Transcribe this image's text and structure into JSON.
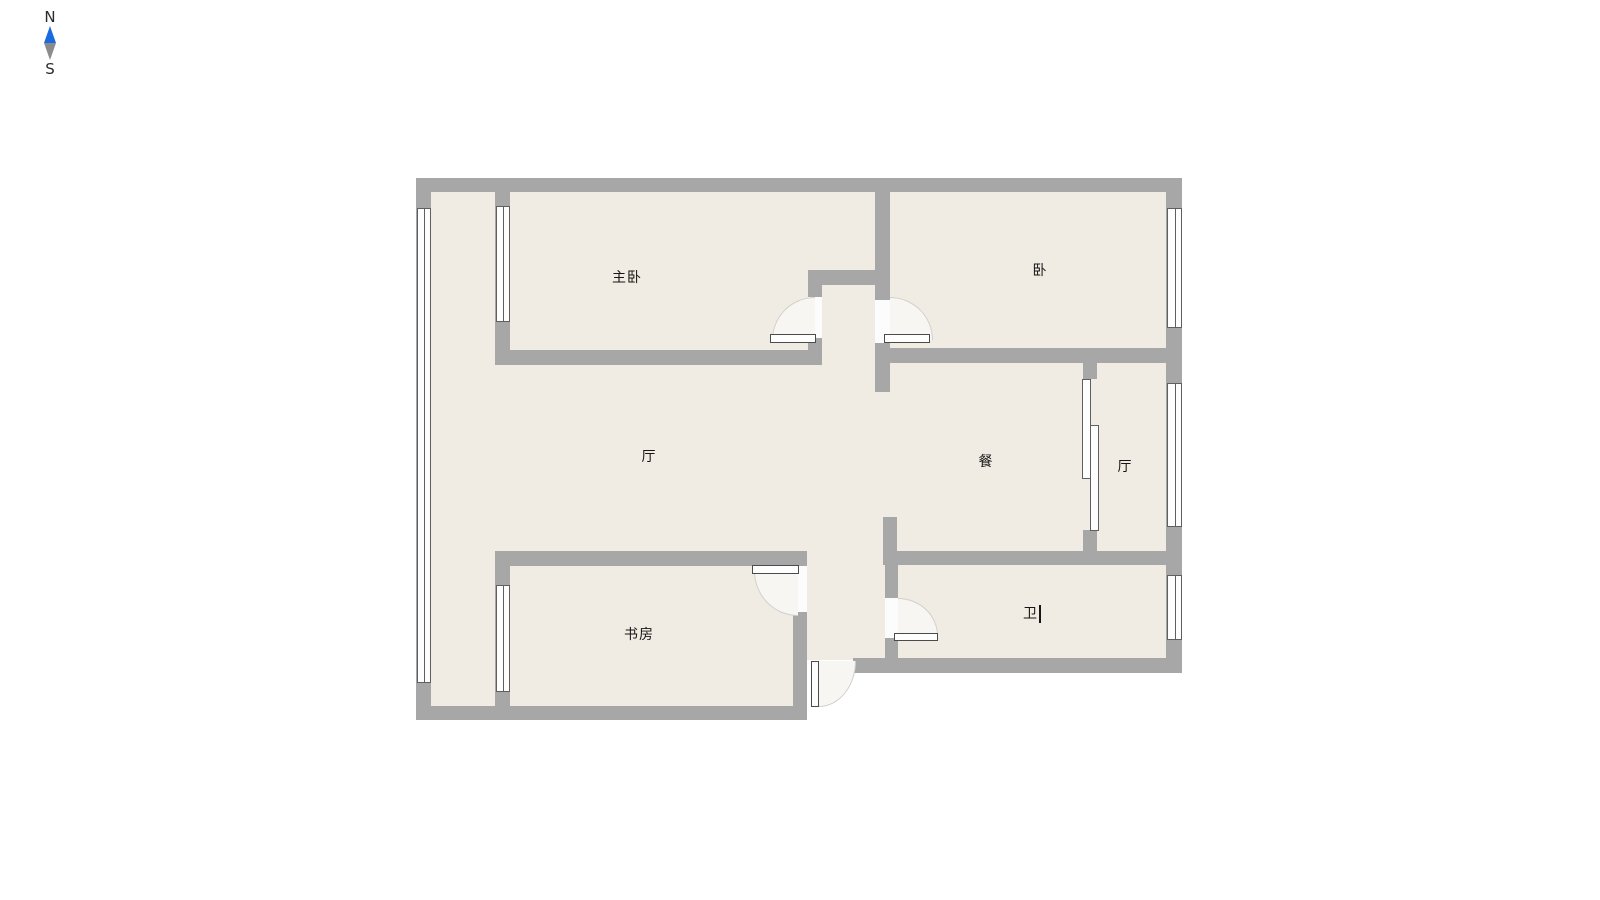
{
  "compass": {
    "north_label": "N",
    "south_label": "S"
  },
  "rooms": [
    {
      "id": "master-bedroom",
      "label": "主卧"
    },
    {
      "id": "bedroom",
      "label": "卧"
    },
    {
      "id": "living-room",
      "label": "厅"
    },
    {
      "id": "dining-room",
      "label": "餐"
    },
    {
      "id": "hall",
      "label": "厅"
    },
    {
      "id": "study",
      "label": "书房"
    },
    {
      "id": "bathroom",
      "label": "卫"
    }
  ],
  "editing": {
    "text_cursor_visible_after": "卫"
  },
  "colors": {
    "wall": "#a7a7a7",
    "floor": "#f0ece3",
    "outside": "#ffffff",
    "window_fill": "#fdfdfd",
    "window_border": "#5f5f5f",
    "gap_fill": "#fcfcfc",
    "arc_fill": "#f7f6f2",
    "arc_border": "#d2d0ca",
    "leaf_fill": "#fefefe",
    "leaf_border": "#4b4b4b",
    "label_color": "#161616",
    "compass_north": "#1b6be0",
    "compass_south": "#8b8b8b",
    "compass_text": "#2b2b2b"
  }
}
